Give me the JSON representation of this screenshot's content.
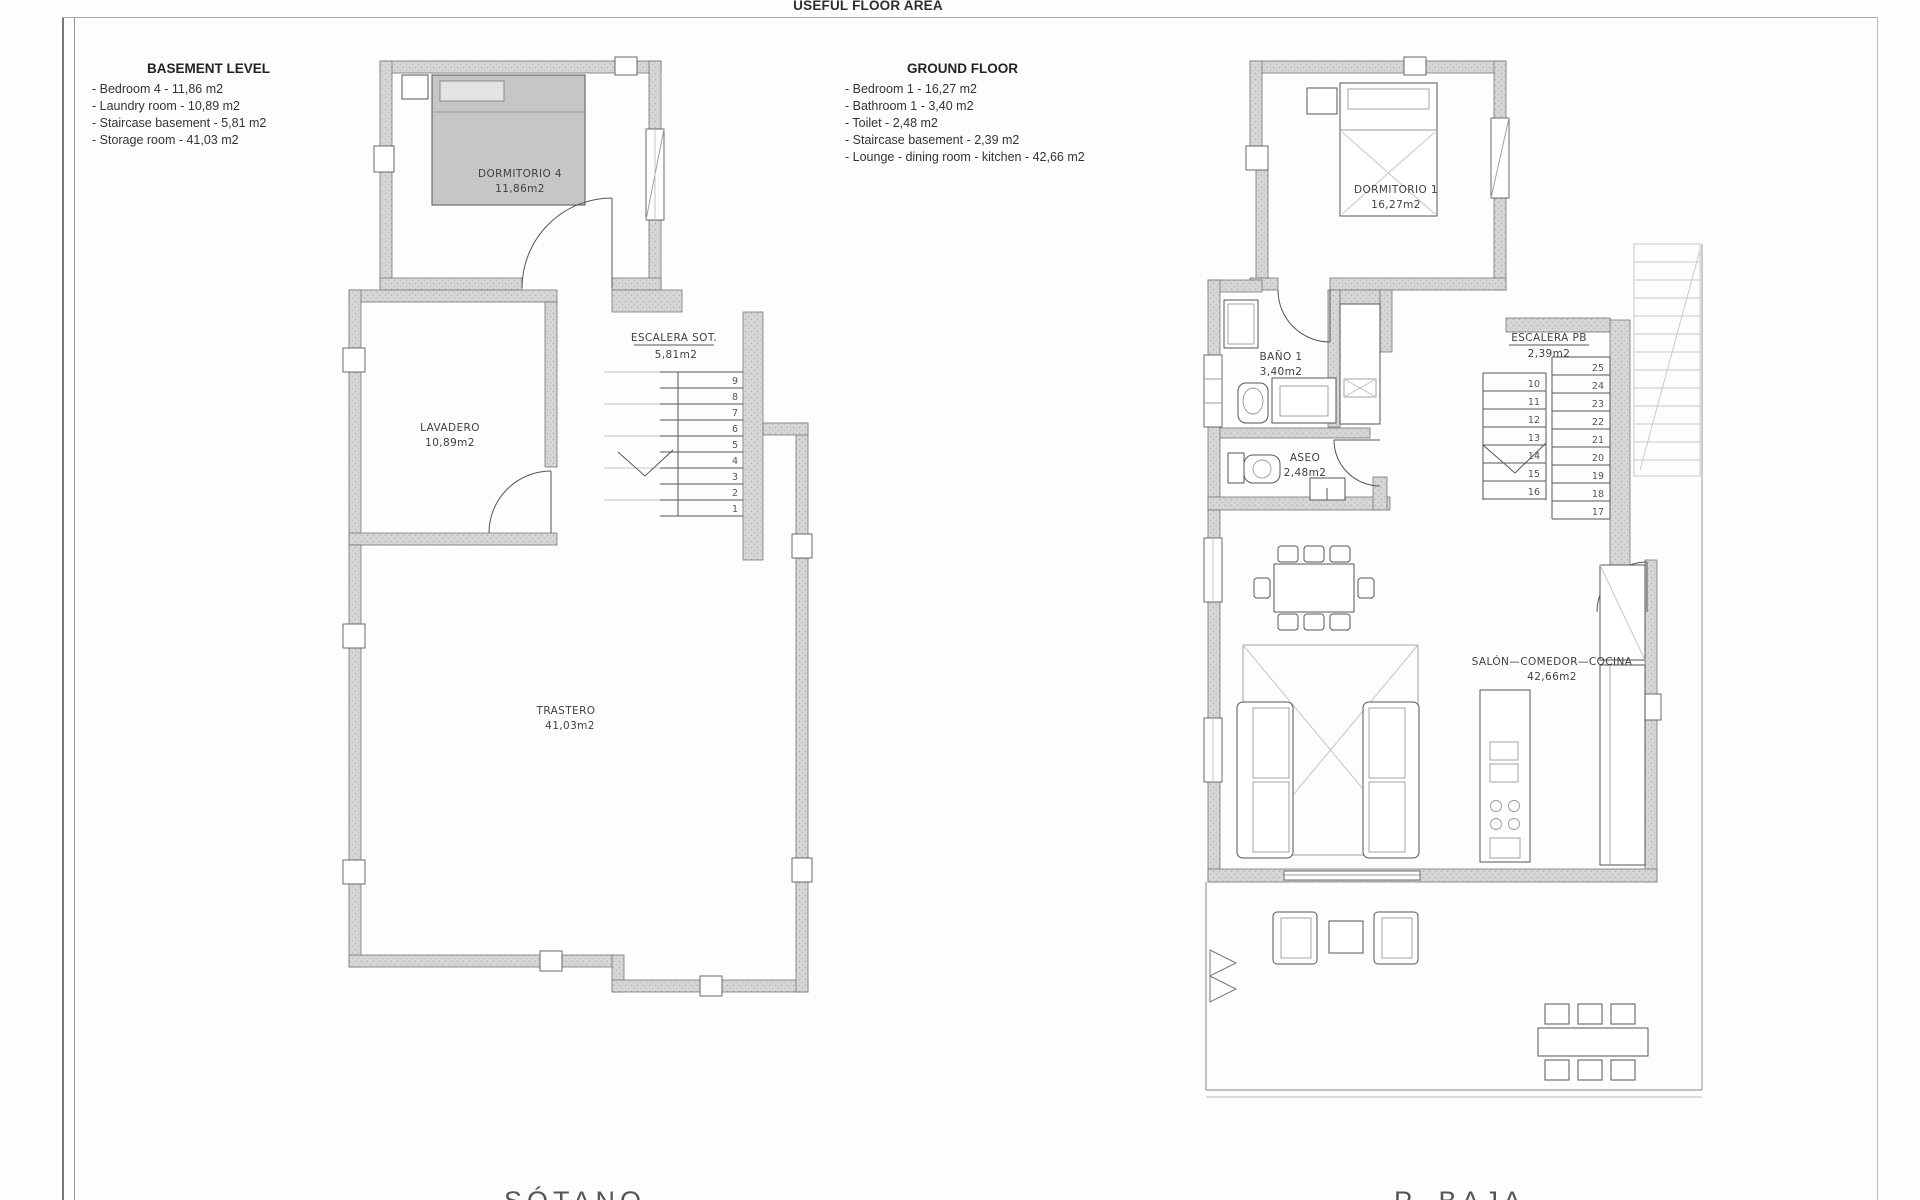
{
  "page": {
    "title": "USEFUL FLOOR AREA",
    "footer_left": "SÓTANO",
    "footer_right": "P. BAJA"
  },
  "legend_basement": {
    "heading": "BASEMENT LEVEL",
    "items": [
      "- Bedroom 4 - 11,86 m2",
      "- Laundry room - 10,89 m2",
      "- Staircase basement - 5,81 m2",
      "- Storage room - 41,03 m2"
    ]
  },
  "legend_ground": {
    "heading": "GROUND FLOOR",
    "items": [
      "- Bedroom 1 - 16,27 m2",
      "- Bathroom 1 - 3,40 m2",
      "- Toilet - 2,48 m2",
      "- Staircase basement - 2,39 m2",
      "- Lounge - dining room - kitchen - 42,66 m2"
    ]
  },
  "basement_plan": {
    "rooms": {
      "bedroom4": {
        "name": "DORMITORIO 4",
        "area": "11,86m2"
      },
      "staircase": {
        "name": "ESCALERA SOT.",
        "area": "5,81m2"
      },
      "laundry": {
        "name": "LAVADERO",
        "area": "10,89m2"
      },
      "storage": {
        "name": "TRASTERO",
        "area": "41,03m2"
      }
    },
    "stair_numbers": [
      "9",
      "8",
      "7",
      "6",
      "5",
      "4",
      "3",
      "2",
      "1"
    ]
  },
  "ground_plan": {
    "rooms": {
      "bedroom1": {
        "name": "DORMITORIO 1",
        "area": "16,27m2"
      },
      "bathroom": {
        "name": "BAÑO 1",
        "area": "3,40m2"
      },
      "toilet": {
        "name": "ASEO",
        "area": "2,48m2"
      },
      "staircase": {
        "name": "ESCALERA PB",
        "area": "2,39m2"
      },
      "lounge": {
        "name": "SALÓN—COMEDOR—COCINA",
        "area": "42,66m2"
      }
    },
    "stair_numbers_left": [
      "10",
      "11",
      "12",
      "13",
      "14",
      "15",
      "16"
    ],
    "stair_numbers_right": [
      "25",
      "24",
      "23",
      "22",
      "21",
      "20",
      "19",
      "18",
      "17"
    ]
  },
  "colors": {
    "wall_fill": "#d6d6d6",
    "line": "#555555",
    "text": "#3f3f3f"
  }
}
